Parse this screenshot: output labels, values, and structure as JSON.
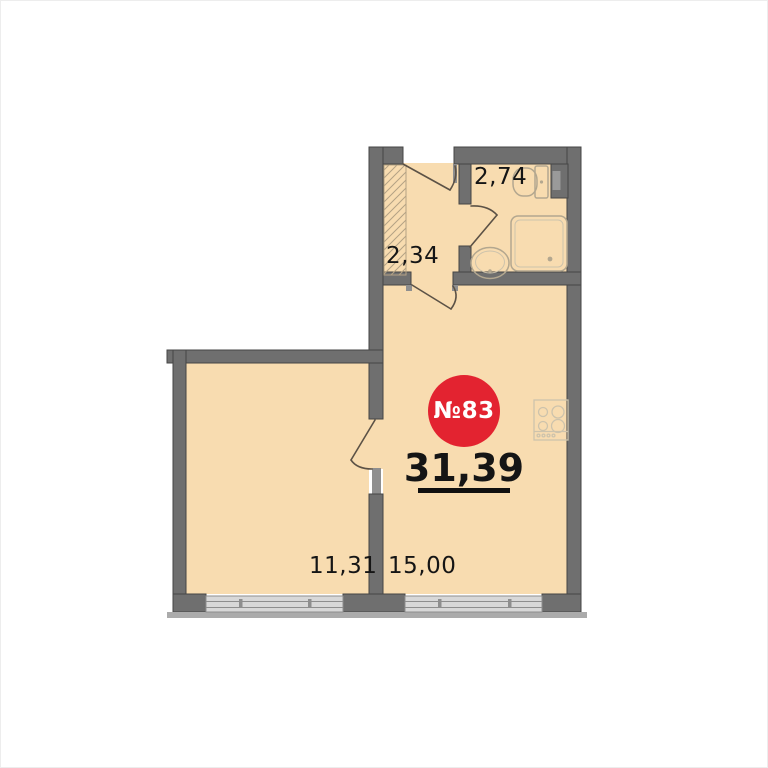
{
  "plan": {
    "unit_badge": "№83",
    "total_area": "31,39",
    "rooms": [
      {
        "id": "bathroom",
        "area": "2,74"
      },
      {
        "id": "hallway",
        "area": "2,34"
      },
      {
        "id": "room",
        "area": "11,31"
      },
      {
        "id": "kitchen-living",
        "area": "15,00"
      }
    ]
  },
  "icons": {
    "toilet-icon": "outlined bowl with tank",
    "sink-icon": "double ellipse with drain dot",
    "shower-icon": "rounded square tray with drain dot",
    "stove-icon": "square hob with 4 burners and 4 knobs",
    "door-swing-icon": "leaf line with quarter arc",
    "window-icon": "triple-line glazing band",
    "wardrobe-hatch-icon": "diagonal hatched rectangle",
    "duct-icon": "dark L-shaped shaft block"
  },
  "colors": {
    "floor": "#f8dcb0",
    "wall": "#6f6f6f",
    "wallEdge": "#454545",
    "wallLight": "#8f8f8f",
    "windowFill": "#d8d8d8",
    "windowLine": "#8e8e8e",
    "sill": "#ababab",
    "fixture": "#b3a78f",
    "fixtureLight": "#cdc3ac",
    "hatch": "#b4a284",
    "door": "#5c5246",
    "badge": "#e32330",
    "badgeText": "#ffffff",
    "label": "#151515"
  }
}
